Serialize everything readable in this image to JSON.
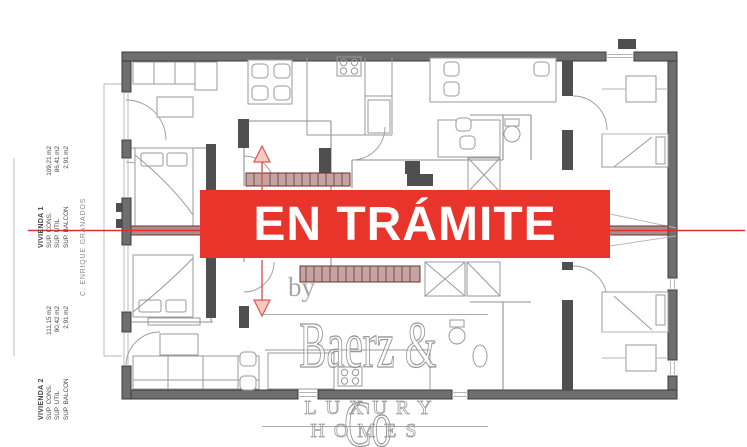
{
  "banner": {
    "text": "EN TRÁMITE",
    "bg_color": "#e8342b",
    "text_color": "#ffffff"
  },
  "watermark": {
    "by": "by",
    "name": "Baerz & Co",
    "tagline": "LUXURY HOMES"
  },
  "street_label": "C. ENRIQUE GRANADOS",
  "apartments": [
    {
      "title": "VIVIENDA 1",
      "rows": [
        {
          "label": "SUP. CONS.",
          "value": "109,21 m2"
        },
        {
          "label": "SUP. UTIL",
          "value": "86,41 m2"
        },
        {
          "label": "SUP. BALCON",
          "value": "2,91 m2"
        }
      ]
    },
    {
      "title": "VIVIENDA 2",
      "rows": [
        {
          "label": "SUP. CONS.",
          "value": "111,15 m2"
        },
        {
          "label": "SUP. UTIL",
          "value": "90,42 m2"
        },
        {
          "label": "SUP. BALCON",
          "value": "2,91 m2"
        }
      ]
    }
  ],
  "plan": {
    "wall_color": "#6e6e6e",
    "partition_color": "#8f8f8f",
    "section_line_color": "#e0312a",
    "stair_color": "#b98f8f"
  }
}
